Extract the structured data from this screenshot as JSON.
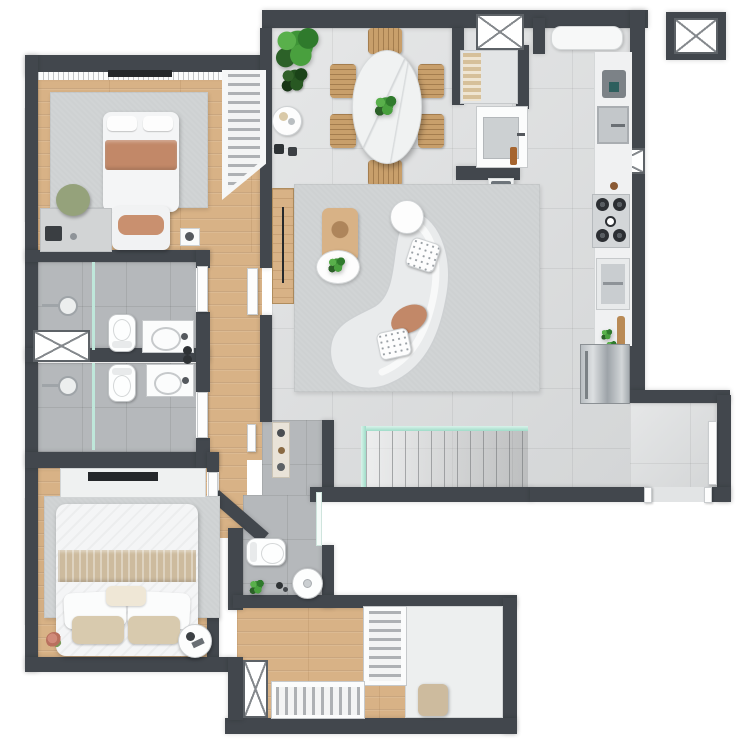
{
  "meta": {
    "kind": "apartment-floor-plan-3d-render",
    "description": "Top-down photorealistic render of a two-bedroom apartment; no text labels are visible in the image",
    "canvas": {
      "width": 744,
      "height": 744
    }
  },
  "colors": {
    "wall": "#42474d",
    "wood": "#d8b286",
    "tile": "#d8dadb",
    "btile": "#b5b8bb",
    "rug": "#ced1d2",
    "glass": "#9fdcc8",
    "white": "#fbfcfc",
    "marble": "#f0f2f2",
    "salmon": "#c28868",
    "beige": "#d6c09a",
    "beige_band": "#cdbb9e",
    "green": "#3e9437",
    "green_dark": "#2c6128",
    "chair_wood": "#c89f6b",
    "steel": "#aeb4b9",
    "dark": "#24272a",
    "olive_chair": "#95a27b"
  },
  "counts": {
    "bedrooms": 2,
    "bathrooms": 3,
    "dining_chairs": 6,
    "island_stools": 4,
    "stove_burners": 4,
    "duct_shafts": 4,
    "windows": 4
  },
  "rooms": [
    {
      "name": "bedroom-1",
      "furniture": [
        "single-bed-salmon-throw",
        "foot-bench",
        "desk",
        "olive-chair",
        "nightstand",
        "open-wardrobe",
        "area-rug",
        "wall-tv",
        "window"
      ]
    },
    {
      "name": "bathroom-1",
      "furniture": [
        "walk-in-shower",
        "toilet",
        "vanity-sink",
        "frosted-window"
      ]
    },
    {
      "name": "bathroom-2",
      "furniture": [
        "walk-in-shower",
        "toilet",
        "vanity-sink",
        "frosted-window"
      ]
    },
    {
      "name": "bedroom-2",
      "furniture": [
        "double-bed-beige-throw",
        "pillows",
        "tv-console",
        "wall-tv",
        "area-rug",
        "round-side-table",
        "flower-pot",
        "window"
      ]
    },
    {
      "name": "lavatory",
      "furniture": [
        "toilet",
        "pedestal-sink",
        "potted-plant",
        "decor-shelf",
        "glass-partition"
      ]
    },
    {
      "name": "walk-in-closet",
      "furniture": [
        "hanging-wardrobe-vertical",
        "hanging-wardrobe-horizontal",
        "cabinet-panel",
        "ottoman"
      ]
    },
    {
      "name": "dining-area",
      "furniture": [
        "oval-marble-table",
        "six-wood-chairs",
        "green-centerpiece",
        "fiddle-leaf-plant",
        "small-dark-plant",
        "coffee-side-table",
        "wood-sideboard"
      ]
    },
    {
      "name": "living-room",
      "furniture": [
        "curved-sofa",
        "round-sofa-table",
        "polka-dot-pillows",
        "salmon-pillow",
        "wood-coffee-table",
        "round-tray-table",
        "area-rug"
      ]
    },
    {
      "name": "kitchen",
      "furniture": [
        "island-counter-with-cooktop",
        "four-stools",
        "window-bench",
        "coffee-machine",
        "kitchen-sink",
        "gas-stove-4-burners",
        "oven",
        "cutting-board",
        "herb-pots",
        "stainless-fridge"
      ]
    },
    {
      "name": "entry-hall",
      "furniture": [
        "slatted-bench",
        "washbasin-cabinet",
        "glass-sliding-door",
        "service-shaft"
      ]
    },
    {
      "name": "staircase",
      "furniture": [
        "steps-going-down",
        "glass-railing"
      ]
    },
    {
      "name": "rear-corridor",
      "furniture": [
        "door-leaf",
        "door-opening"
      ]
    },
    {
      "name": "elevator-core-external",
      "furniture": [
        "elevator-shaft-x-box"
      ]
    }
  ]
}
